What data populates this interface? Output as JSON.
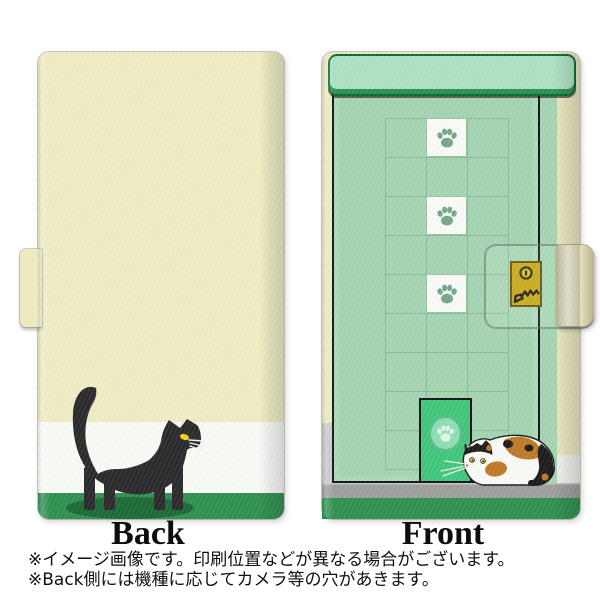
{
  "page": {
    "background": "#FFFFFF"
  },
  "back_view": {
    "label": "Back",
    "design": "black cat walking on two-tone ground",
    "base_color": "#F0EEC4",
    "band_color": "#FAFAF7",
    "ground_color": "#2F9150",
    "shadow_color": "#1C6B36",
    "cat_color": "#2B2B2E",
    "cat_eye_color": "#F2D21E"
  },
  "front_view": {
    "label": "Front",
    "design": "green door with paw-print windows, lock plate, cat door and calico cat",
    "door_color": "#A5D6B3",
    "lintel_color": "#AFE2C4",
    "lintel_border_color": "#0E6B33",
    "frame_color": "#141414",
    "grid_line_color": "#8BB998",
    "paw_color": "#74A888",
    "cat_door_color": "#40C87C",
    "lock_plate_color": "#C6A60C",
    "floor_color": "#9EA09E",
    "ground_color": "#2F9150",
    "spine_color": "#EDE9C0",
    "calico_white": "#FBFBF7",
    "calico_orange": "#C07A28",
    "calico_black": "#1C1C1C"
  },
  "footer": {
    "note1": "※イメージ画像です。印刷位置などが異なる場合がございます。",
    "note2": "※Back側には機種に応じてカメラ等の穴があきます。"
  }
}
